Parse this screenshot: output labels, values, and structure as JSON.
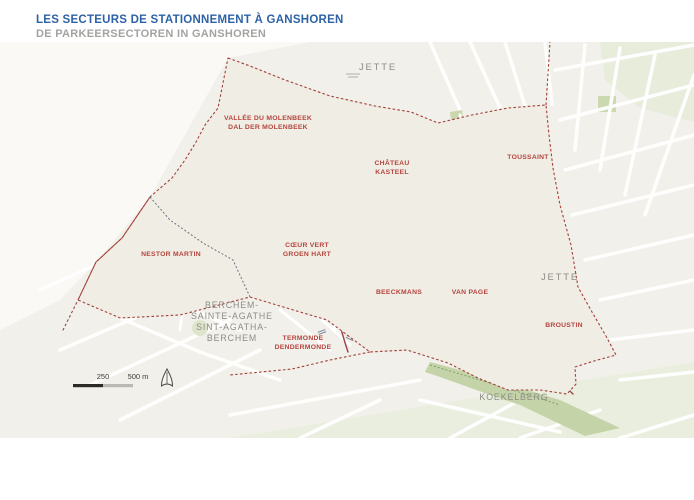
{
  "header": {
    "title_fr": "LES SECTEURS DE STATIONNEMENT À GANSHOREN",
    "title_nl": "DE PARKEERSECTOREN IN GANSHOREN"
  },
  "map": {
    "sector_labels": {
      "vallee": {
        "line1": "VALLÉE DU MOLENBEEK",
        "line2": "DAL DER MOLENBEEK"
      },
      "chateau": {
        "line1": "CHÂTEAU",
        "line2": "KASTEEL"
      },
      "toussaint": {
        "line1": "TOUSSAINT"
      },
      "nestor_martin": {
        "line1": "NESTOR MARTIN"
      },
      "coeur_vert": {
        "line1": "CŒUR VERT",
        "line2": "GROEN HART"
      },
      "beeckmans": {
        "line1": "BEECKMANS"
      },
      "van_page": {
        "line1": "VAN PAGE"
      },
      "broustin": {
        "line1": "BROUSTIN"
      },
      "termonde": {
        "line1": "TERMONDE",
        "line2": "DENDERMONDE"
      }
    },
    "neighbor_labels": {
      "jette_north": "JETTE",
      "jette_east": "JETTE",
      "koekelberg": "KOEKELBERG",
      "berchem": {
        "line1": "BERCHEM-",
        "line2": "SAINTE-AGATHE",
        "line3": "SINT-AGATHA-",
        "line4": "BERCHEM"
      }
    },
    "scale_bar": {
      "mid_label": "250",
      "end_label": "500 m"
    },
    "colors": {
      "title_blue": "#2E62A6",
      "sector_red": "#B5453E",
      "boundary_red": "#A2403A",
      "neighbor_gray": "#8C8D86",
      "ganshoren_beige": "#DFDAC9",
      "park_green": "#C2D1A3",
      "street_label_blue": "#5A6C84"
    }
  }
}
